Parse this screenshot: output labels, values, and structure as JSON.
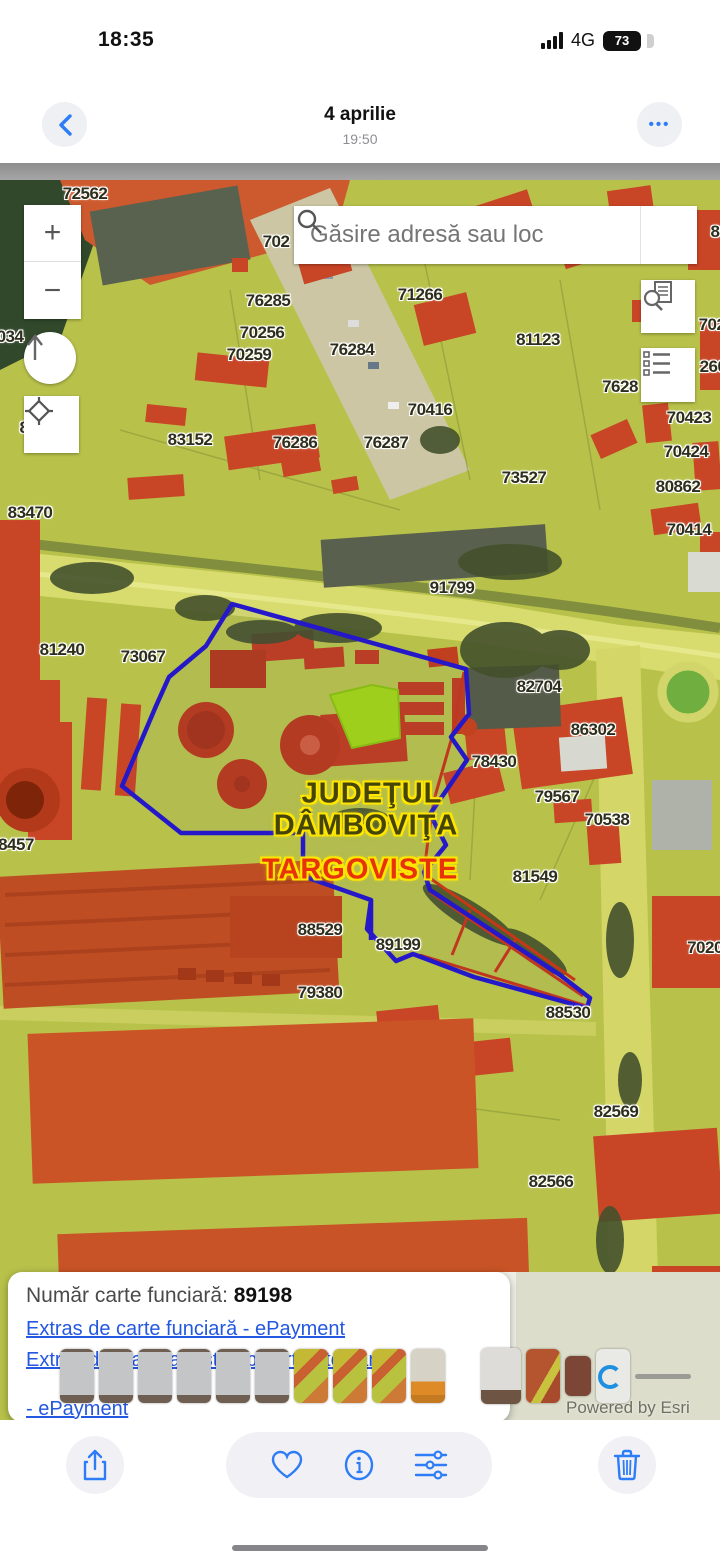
{
  "status_bar": {
    "time": "18:35",
    "network": "4G",
    "battery_percent": "73"
  },
  "nav_bar": {
    "title": "4 aprilie",
    "subtitle": "19:50",
    "more_glyph": "•••"
  },
  "map": {
    "search_placeholder": "Găsire adresă sau loc",
    "zoom_in_glyph": "+",
    "zoom_out_glyph": "−",
    "county_line1": "JUDEŢUL",
    "county_line2": "DÂMBOVIŢA",
    "city_label": "TARGOVISTE",
    "attribution": "Powered by Esri",
    "parcel_labels": [
      {
        "text": "72562",
        "x": 85,
        "y": 14
      },
      {
        "text": "702",
        "x": 276,
        "y": 62
      },
      {
        "text": "8",
        "x": 715,
        "y": 52
      },
      {
        "text": "76285",
        "x": 268,
        "y": 121
      },
      {
        "text": "71266",
        "x": 420,
        "y": 115
      },
      {
        "text": "70256",
        "x": 262,
        "y": 153
      },
      {
        "text": "70259",
        "x": 249,
        "y": 175
      },
      {
        "text": "76284",
        "x": 352,
        "y": 170
      },
      {
        "text": "81123",
        "x": 538,
        "y": 160
      },
      {
        "text": "702",
        "x": 712,
        "y": 145
      },
      {
        "text": "7628",
        "x": 620,
        "y": 207
      },
      {
        "text": "260",
        "x": 713,
        "y": 187
      },
      {
        "text": "70416",
        "x": 430,
        "y": 230
      },
      {
        "text": "83152",
        "x": 190,
        "y": 260
      },
      {
        "text": "76286",
        "x": 295,
        "y": 263
      },
      {
        "text": "76287",
        "x": 386,
        "y": 263
      },
      {
        "text": "73527",
        "x": 524,
        "y": 298
      },
      {
        "text": "70423",
        "x": 689,
        "y": 238
      },
      {
        "text": "70424",
        "x": 686,
        "y": 272
      },
      {
        "text": "80862",
        "x": 678,
        "y": 307
      },
      {
        "text": "83470",
        "x": 30,
        "y": 333
      },
      {
        "text": "70414",
        "x": 689,
        "y": 350
      },
      {
        "text": "91799",
        "x": 452,
        "y": 408
      },
      {
        "text": "81240",
        "x": 62,
        "y": 470
      },
      {
        "text": "73067",
        "x": 143,
        "y": 477
      },
      {
        "text": "82704",
        "x": 539,
        "y": 507
      },
      {
        "text": "86302",
        "x": 593,
        "y": 550
      },
      {
        "text": "78430",
        "x": 494,
        "y": 582
      },
      {
        "text": "79567",
        "x": 557,
        "y": 617
      },
      {
        "text": "70538",
        "x": 607,
        "y": 640
      },
      {
        "text": "81549",
        "x": 535,
        "y": 697
      },
      {
        "text": "8457",
        "x": 16,
        "y": 665
      },
      {
        "text": "88529",
        "x": 320,
        "y": 750
      },
      {
        "text": "89199",
        "x": 398,
        "y": 765
      },
      {
        "text": "79380",
        "x": 320,
        "y": 813
      },
      {
        "text": "88530",
        "x": 568,
        "y": 833
      },
      {
        "text": "7020",
        "x": 705,
        "y": 768
      },
      {
        "text": "82569",
        "x": 616,
        "y": 932
      },
      {
        "text": "82566",
        "x": 551,
        "y": 1002
      },
      {
        "text": "034",
        "x": 10,
        "y": 157
      },
      {
        "text": "8",
        "x": 24,
        "y": 248
      }
    ]
  },
  "popup": {
    "field_label": "Număr carte funciară: ",
    "field_value": "89198",
    "link1": "Extras de carte funciară - ePayment",
    "link2_line1": "Extras de plan cadastral pe ortofotoplan",
    "link2_line2": "- ePayment"
  },
  "filmstrip": {
    "thumbs": [
      {
        "kind": "doc"
      },
      {
        "kind": "doc"
      },
      {
        "kind": "doc"
      },
      {
        "kind": "doc"
      },
      {
        "kind": "doc"
      },
      {
        "kind": "doc"
      },
      {
        "kind": "mapy"
      },
      {
        "kind": "mapy"
      },
      {
        "kind": "mapy"
      },
      {
        "kind": "docfig"
      },
      {
        "kind": "gap"
      },
      {
        "kind": "cur"
      },
      {
        "kind": "mapr"
      },
      {
        "kind": "maps"
      },
      {
        "kind": "docb"
      },
      {
        "kind": "line"
      }
    ]
  },
  "colors": {
    "accent_blue": "#2e7cf6",
    "parcel_outline_blue": "#2418c9",
    "boundary_red": "#c63818",
    "highlight_green": "#a4d616",
    "close_button_orange": "#f0572a",
    "link_blue": "#2458e0"
  }
}
